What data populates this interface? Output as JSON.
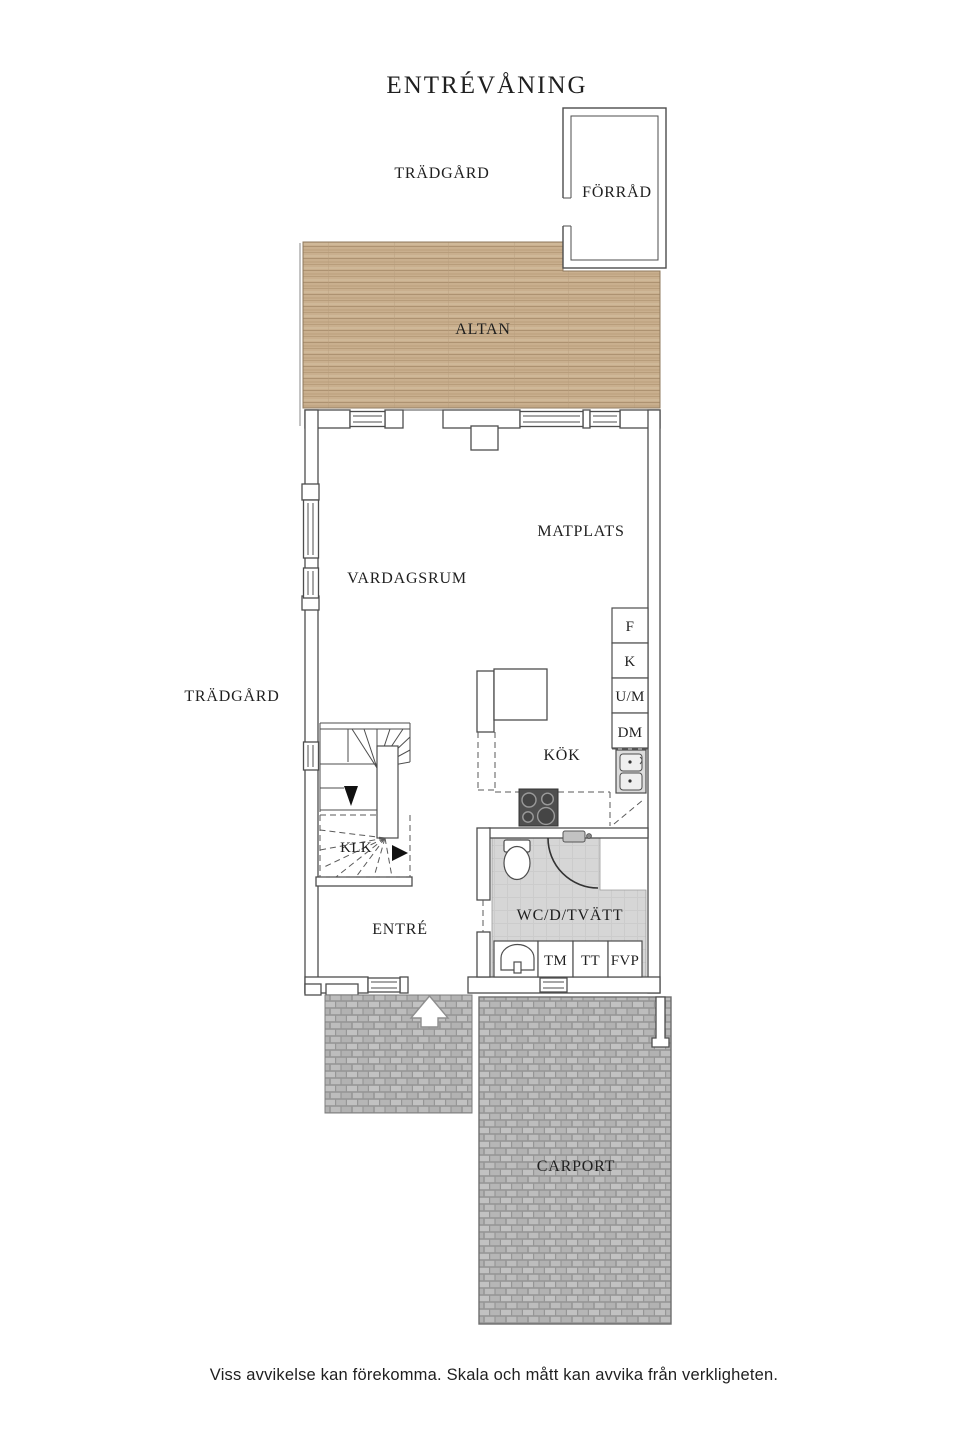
{
  "title": "ENTRÉVÅNING",
  "footer": "Viss avvikelse kan förekomma. Skala och mått kan avvika från verkligheten.",
  "rooms": {
    "tradgard_top": "TRÄDGÅRD",
    "tradgard_left": "TRÄDGÅRD",
    "forrad": "FÖRRÅD",
    "altan": "ALTAN",
    "matplats": "MATPLATS",
    "vardagsrum": "VARDAGSRUM",
    "kok": "KÖK",
    "klk": "KLK",
    "entre": "ENTRÉ",
    "wc": "WC/D/TVÄTT",
    "carport": "CARPORT"
  },
  "appliances": {
    "freezer": "F",
    "fridge": "K",
    "oven_micro": "U/M",
    "dishwasher": "DM",
    "washing_machine": "TM",
    "dryer": "TT",
    "heat_pump": "FVP"
  },
  "colors": {
    "wood_deck": "#c9af8e",
    "paving": "#b5b5b5",
    "wet_room_floor": "#d6d6d6",
    "wall_line": "#4d4d4d",
    "text": "#1f1f1f"
  }
}
